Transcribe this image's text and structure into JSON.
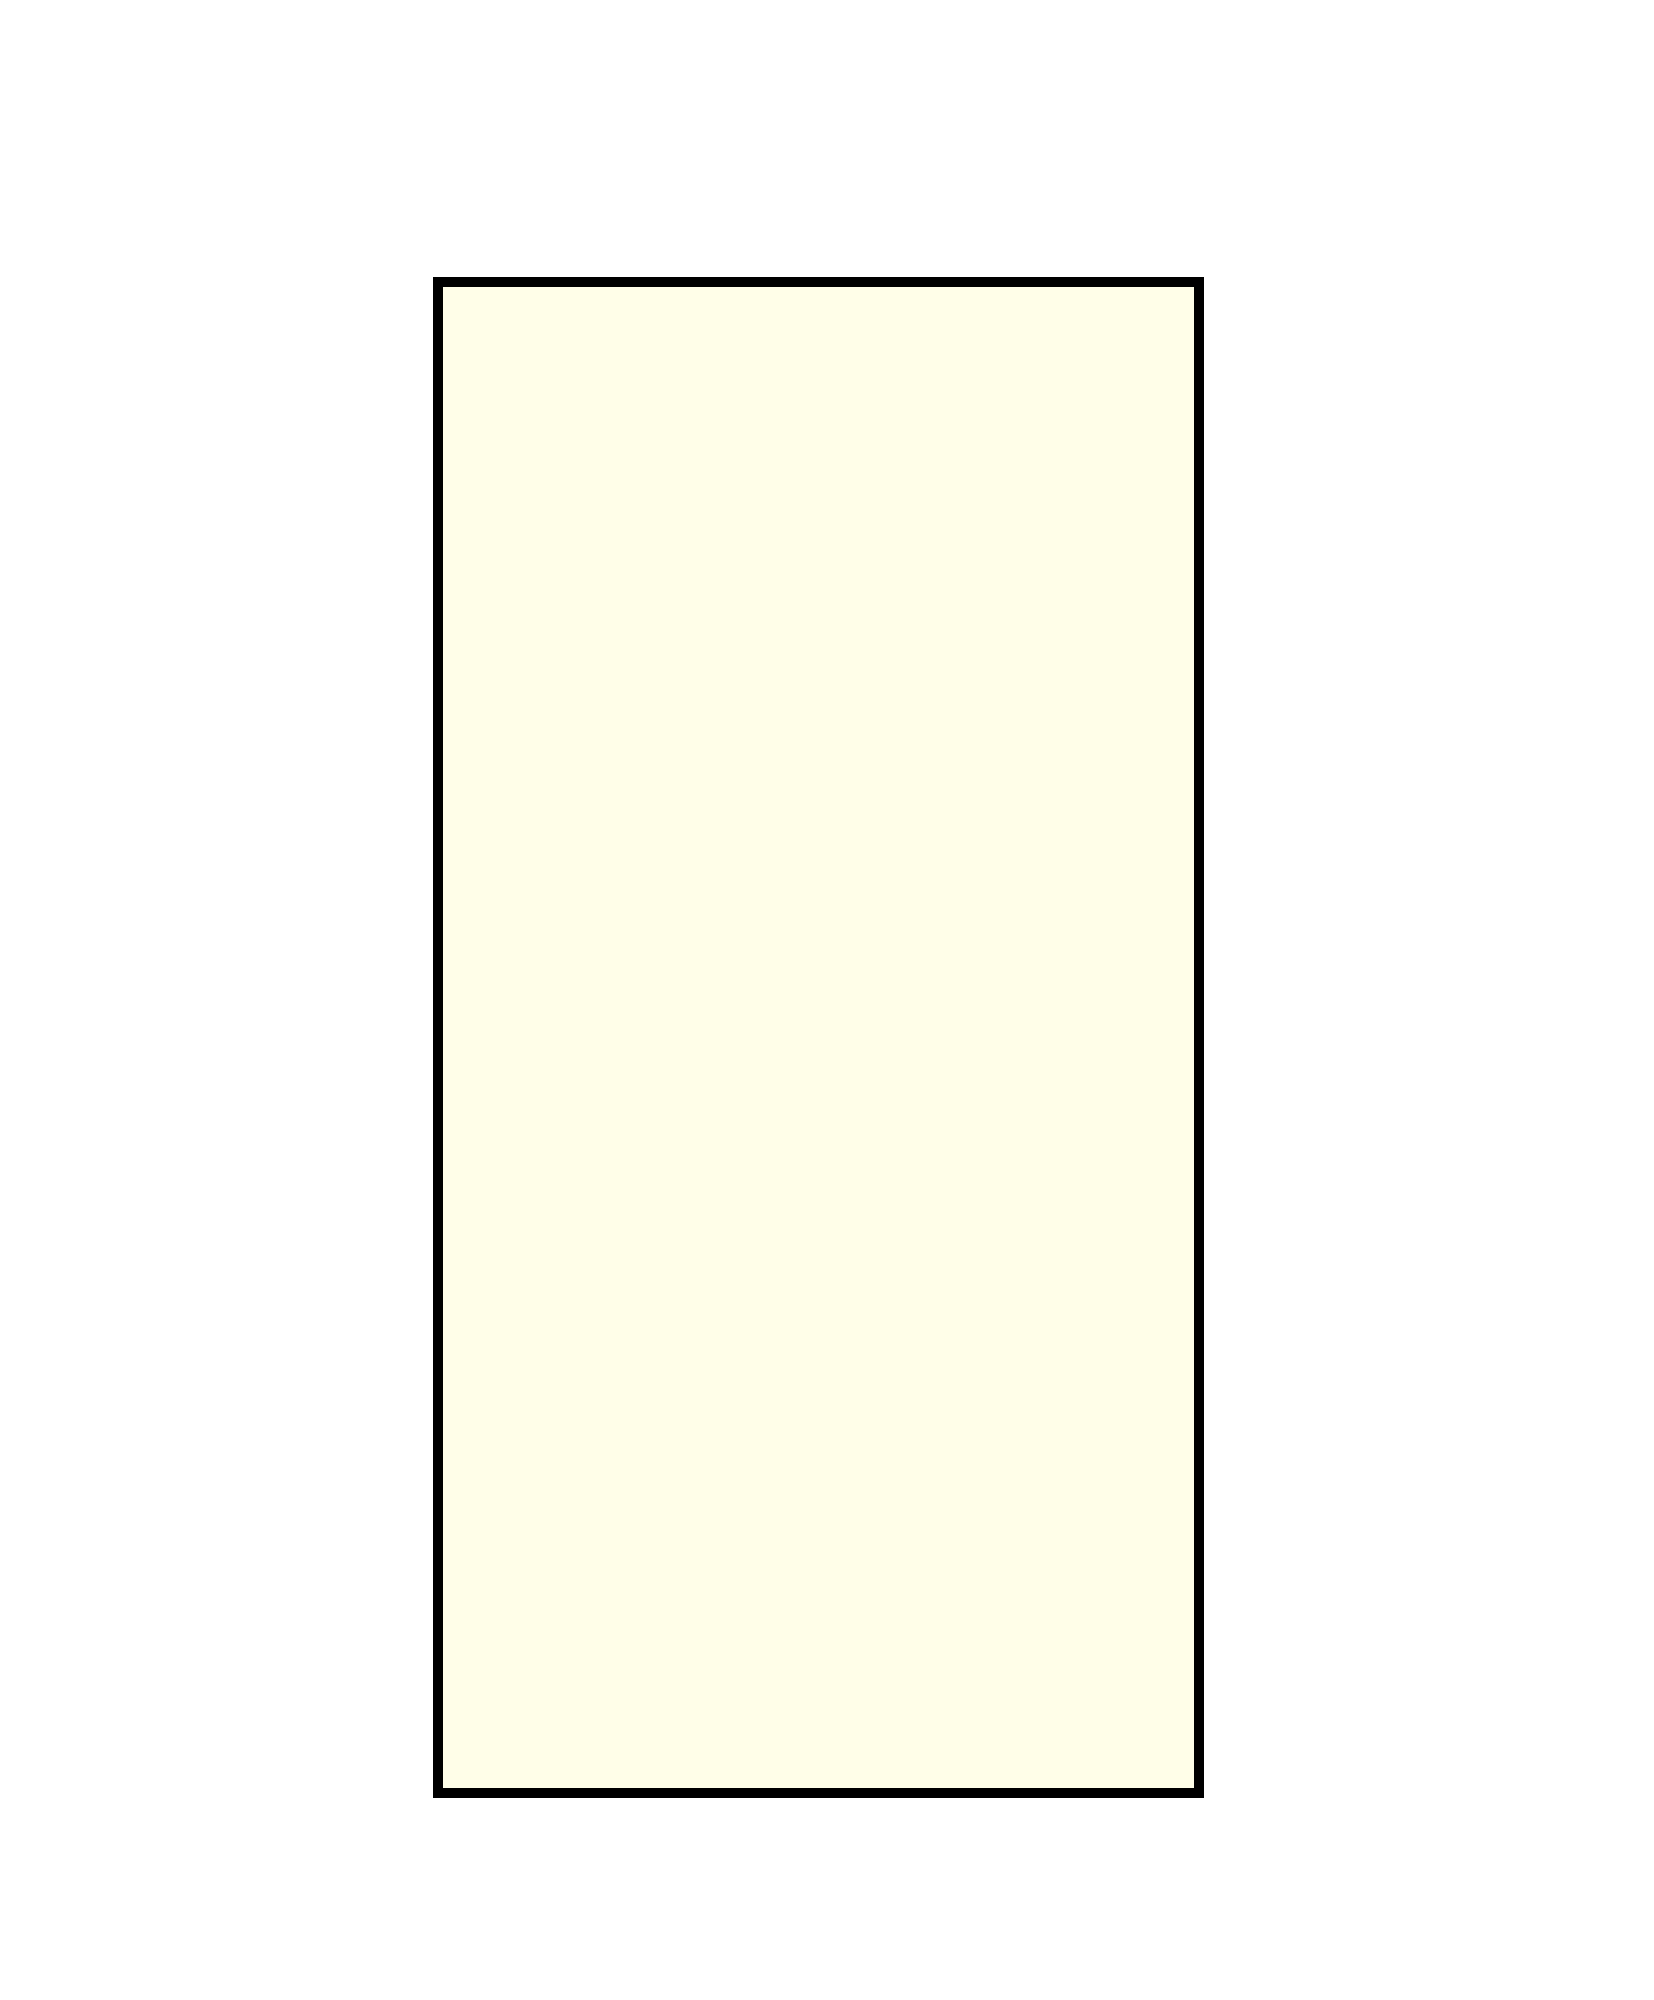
{
  "page": {
    "background_color": "#ffffff"
  },
  "rectangle": {
    "description": "empty bordered panel, no text or content inside",
    "fill_color": "#fffee8",
    "border_color": "#000000"
  }
}
